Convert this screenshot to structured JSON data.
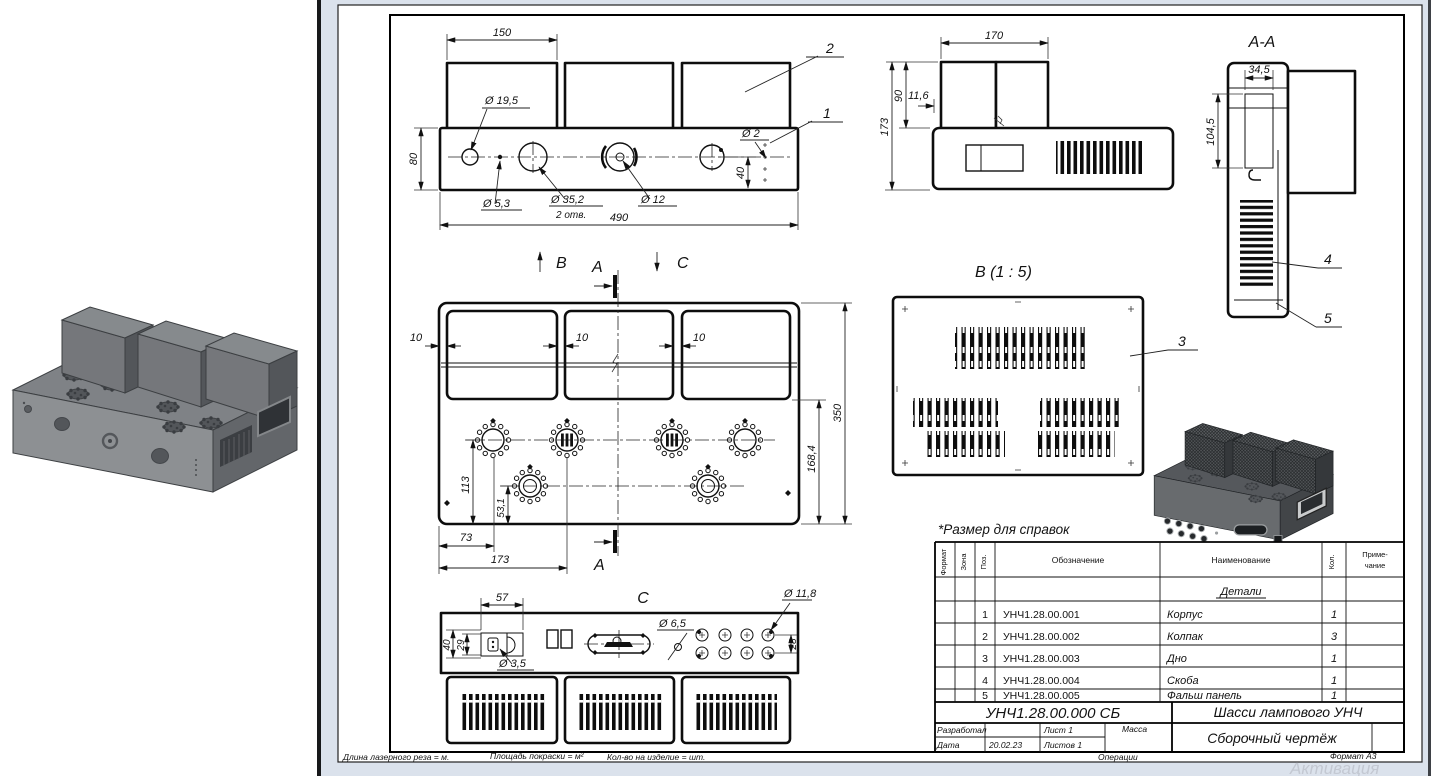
{
  "sheet": {
    "reference_note": "*Размер для справок",
    "views": {
      "front": {
        "dim_box_width": "150",
        "dim_height": "80",
        "dim_total_width": "490",
        "dim_offset_40": "40",
        "dia_19_5": "Ø 19,5",
        "dia_5_3": "Ø 5,3",
        "dia_35_2": "Ø 35,2",
        "dia_35_2_qty": "2 отв.",
        "dia_12": "Ø 12",
        "dia_2": "Ø 2",
        "callout_1": "1",
        "callout_2": "2"
      },
      "side": {
        "dim_width": "170",
        "dim_box_height": "90",
        "dim_offset": "11,6",
        "dim_total_height": "173"
      },
      "section_a": {
        "title": "A-A",
        "dim_width": "34,5",
        "dim_height": "104,5",
        "callout_4": "4",
        "callout_5": "5"
      },
      "top": {
        "mark_b": "B",
        "mark_a_top": "A",
        "mark_c": "C",
        "mark_a_bottom": "A",
        "dim_gap_1": "10",
        "dim_gap_2": "10",
        "dim_gap_3": "10",
        "dim_depth": "350",
        "dim_168": "168,4",
        "dim_113": "113",
        "dim_53": "53,1",
        "dim_73": "73",
        "dim_173": "173"
      },
      "bottom_panel": {
        "title": "B (1 : 5)",
        "callout_3": "3"
      },
      "rear": {
        "title": "C",
        "dim_57": "57",
        "dim_40": "40",
        "dim_29": "29",
        "dia_3_5": "Ø 3,5",
        "dia_6_5": "Ø 6,5",
        "dia_11_8": "Ø 11,8",
        "dim_28": "28"
      }
    },
    "parts_table": {
      "col_format": "Формат",
      "col_zone": "Зона",
      "col_pos": "Поз.",
      "col_designation": "Обозначение",
      "col_name": "Наименование",
      "col_qty": "Кол.",
      "col_note_1": "Приме-",
      "col_note_2": "чание",
      "group_label": "Детали",
      "rows": [
        {
          "pos": "1",
          "designation": "УНЧ1.28.00.001",
          "name": "Корпус",
          "qty": "1"
        },
        {
          "pos": "2",
          "designation": "УНЧ1.28.00.002",
          "name": "Колпак",
          "qty": "3"
        },
        {
          "pos": "3",
          "designation": "УНЧ1.28.00.003",
          "name": "Дно",
          "qty": "1"
        },
        {
          "pos": "4",
          "designation": "УНЧ1.28.00.004",
          "name": "Скоба",
          "qty": "1"
        },
        {
          "pos": "5",
          "designation": "УНЧ1.28.00.005",
          "name": "Фальш панель",
          "qty": "1"
        }
      ]
    },
    "title_block": {
      "doc_number": "УНЧ1.28.00.000 СБ",
      "product_title": "Шасси лампового УНЧ",
      "doc_type": "Сборочный чертёж",
      "developed_label": "Разработал",
      "date_label": "Дата",
      "date_value": "20.02.23",
      "sheet_label": "Лист 1",
      "sheets_label": "Листов 1",
      "mass_label": "Масса",
      "operations_label": "Операции",
      "format_label": "Формат А3"
    },
    "footer": {
      "laser_length": "Длина лазерного реза = м.",
      "paint_area": "Площадь покраски = м²",
      "qty_per_item": "Кол-во на изделие = шт."
    },
    "watermark": "Активация"
  }
}
